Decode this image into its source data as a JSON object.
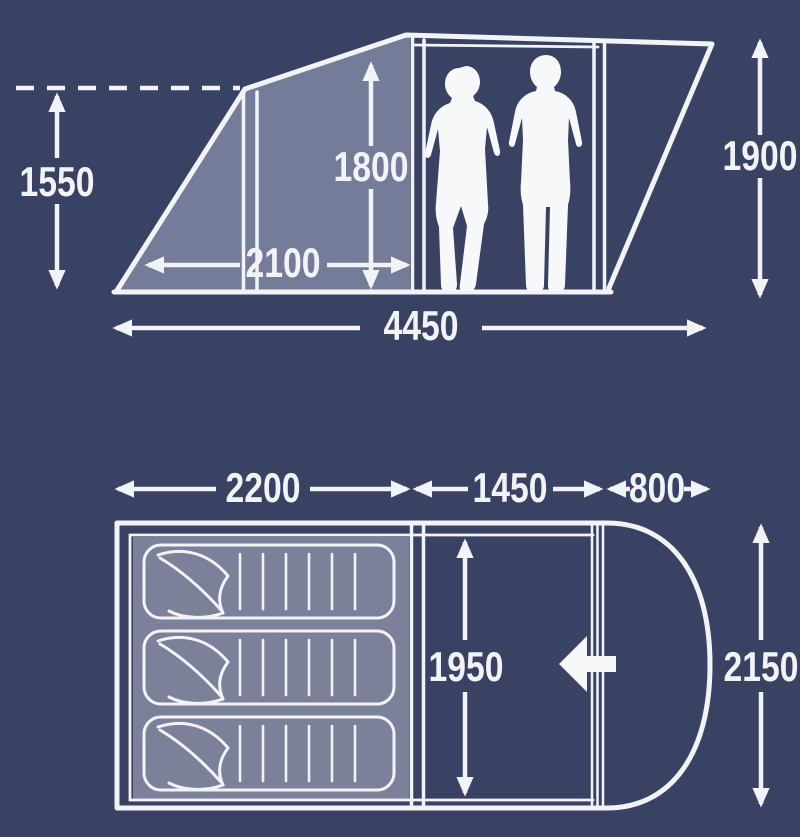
{
  "title": "Tent dimensions diagram",
  "colors": {
    "background": "#3a4264",
    "shaded_panel": "#757c99",
    "sleeping_floor": "#7b8199",
    "line": "#f2f3f7"
  },
  "side_view": {
    "measurements": {
      "front_height": "1550",
      "interior_height": "1800",
      "rear_height": "1900",
      "porch_width": "2100",
      "total_length": "4450"
    }
  },
  "floor_plan": {
    "measurements": {
      "sleeping_width": "2200",
      "living_width": "1450",
      "door_width": "800",
      "interior_depth": "1950",
      "total_depth": "2150"
    },
    "sleeping_bag_count": "3"
  }
}
